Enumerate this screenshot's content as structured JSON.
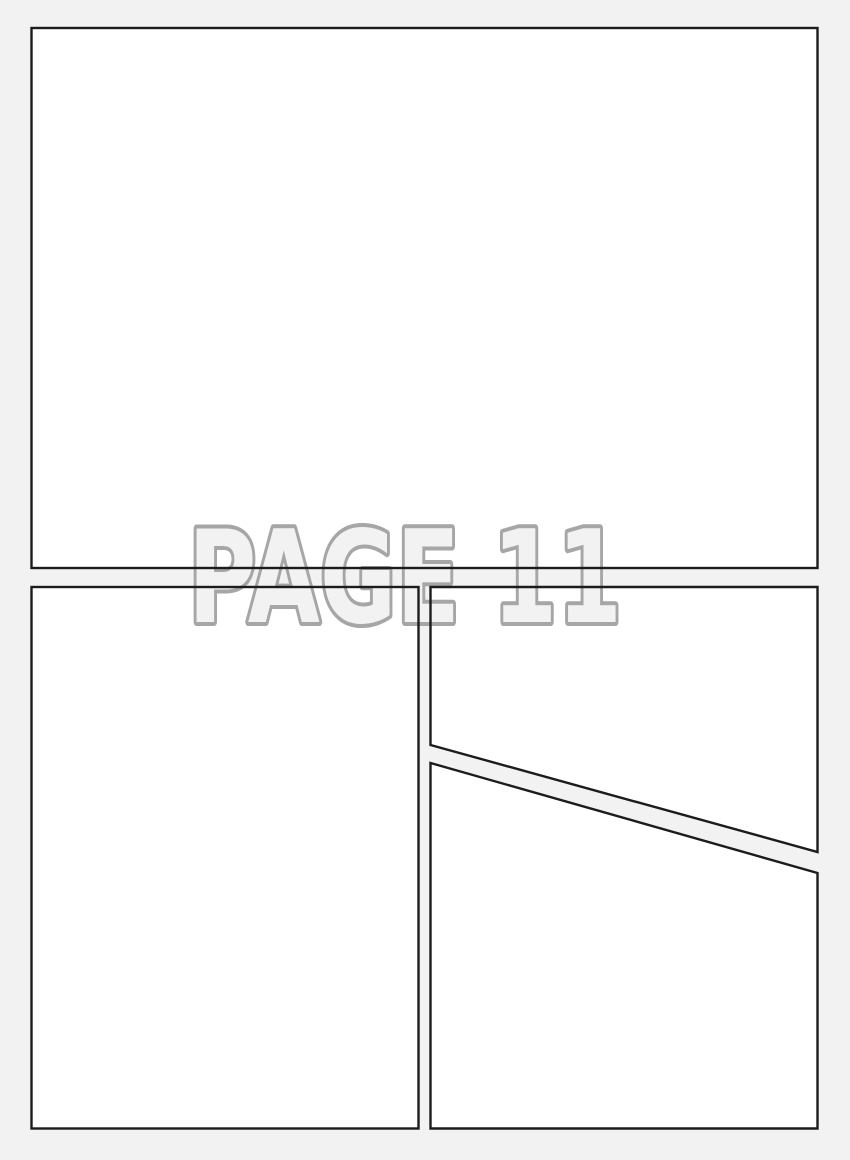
{
  "page": {
    "label": "PAGE 11"
  },
  "colors": {
    "page_bg": "#f2f2f2",
    "panel_fill": "#ffffff",
    "border_color": "#1c1c1c",
    "label_fill": "#f2f2f2",
    "label_stroke": "#a6a6a6"
  },
  "panels": [
    {
      "name": "top-panel"
    },
    {
      "name": "bottom-left-panel"
    },
    {
      "name": "upper-right-panel"
    },
    {
      "name": "lower-right-panel"
    }
  ]
}
